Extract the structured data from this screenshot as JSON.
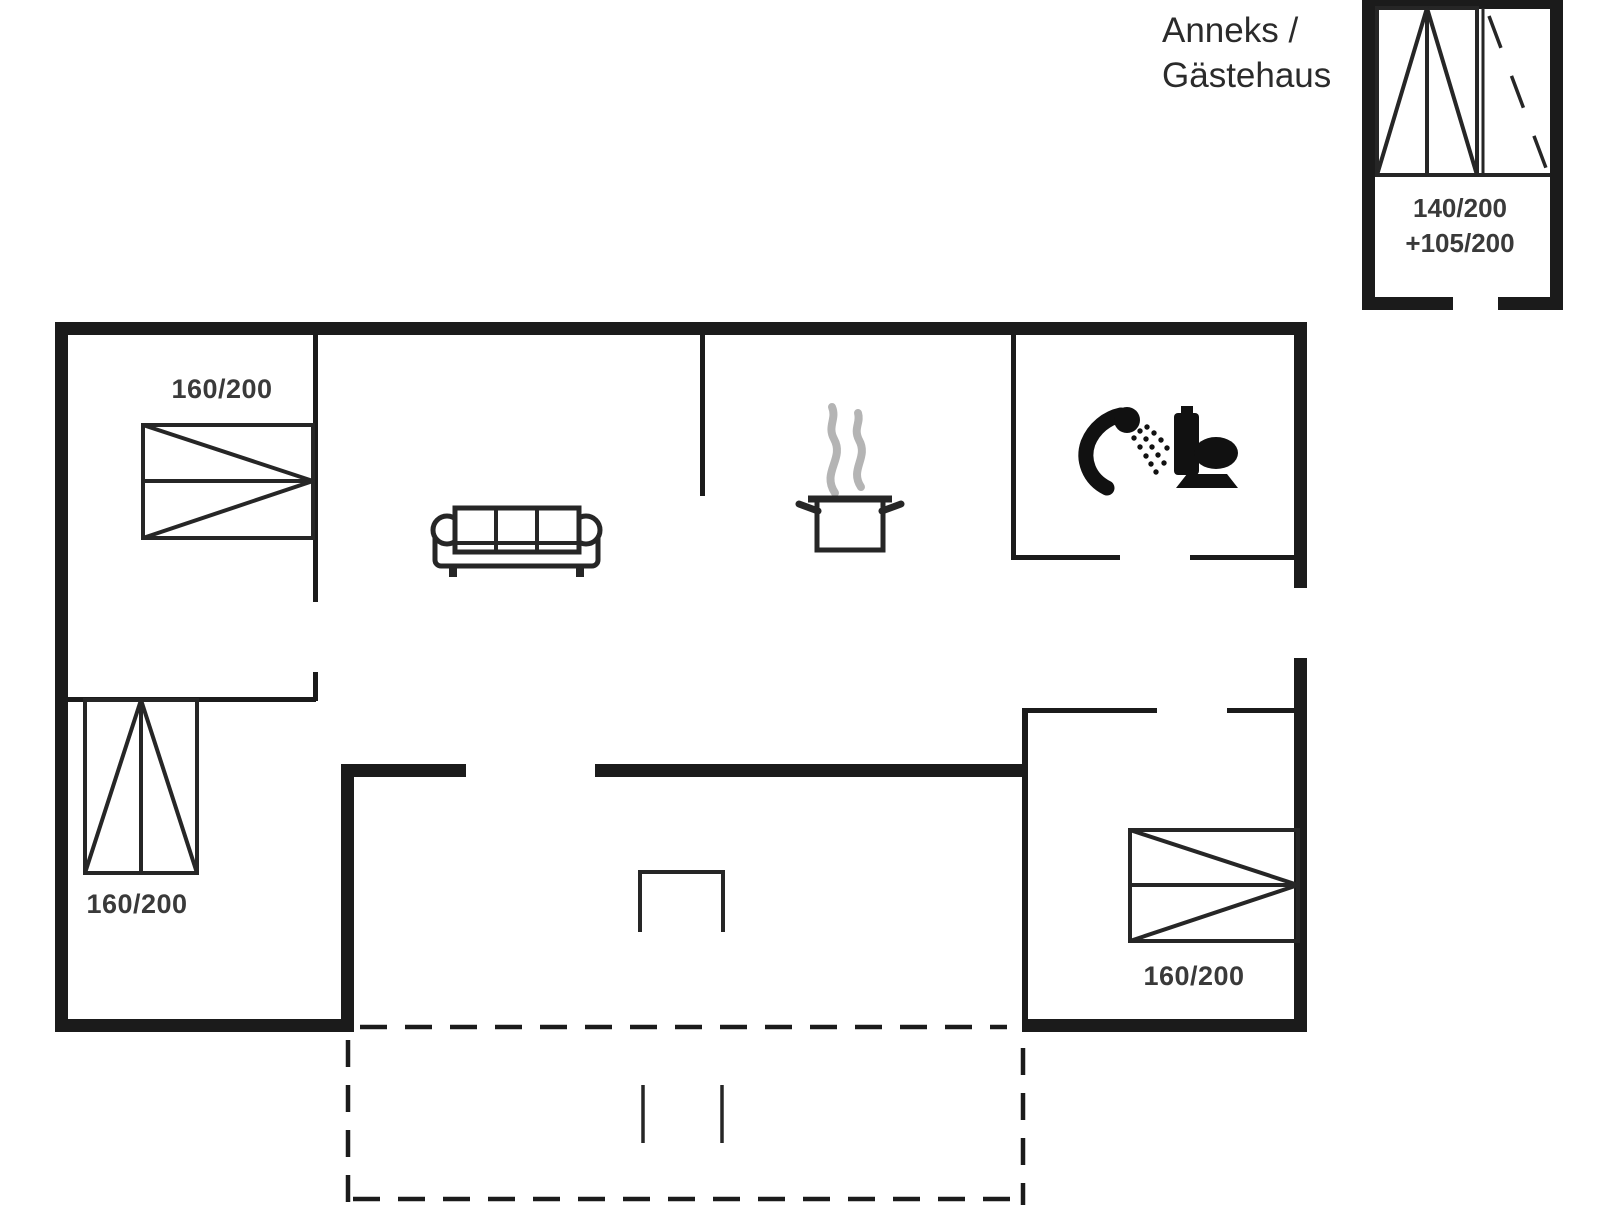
{
  "title": {
    "line1": "Anneks /",
    "line2": "Gästehaus"
  },
  "annex": {
    "bed_label_line1": "140/200",
    "bed_label_line2": "+105/200",
    "double_bed_icon": "double-bed-icon",
    "extra_bed_icon": "dashed-extra-bed-icon"
  },
  "rooms": {
    "bedroom_top_left": {
      "bed_label": "160/200",
      "bed_icon": "double-bed-icon"
    },
    "bedroom_bottom_left": {
      "bed_label": "160/200",
      "bed_icon": "double-bed-icon"
    },
    "bedroom_bottom_right": {
      "bed_label": "160/200",
      "bed_icon": "double-bed-icon"
    },
    "living_room": {
      "sofa_icon": "sofa-icon"
    },
    "kitchen": {
      "pot_icon": "cooking-pot-icon",
      "steam_icon": "steam-icon"
    },
    "bathroom": {
      "shower_icon": "hand-shower-icon",
      "toilet_icon": "toilet-icon"
    },
    "covered_terrace": {
      "marker_icon": "open-rectangle-step-marker"
    },
    "terrace": {
      "outline_style": "dashed",
      "marker_icon": "step-marks"
    }
  },
  "colors": {
    "wall": "#1b1b1b",
    "furniture_line": "#262626",
    "steam": "#b4b4b4",
    "label_text": "#3a3a3a",
    "background": "#ffffff"
  }
}
